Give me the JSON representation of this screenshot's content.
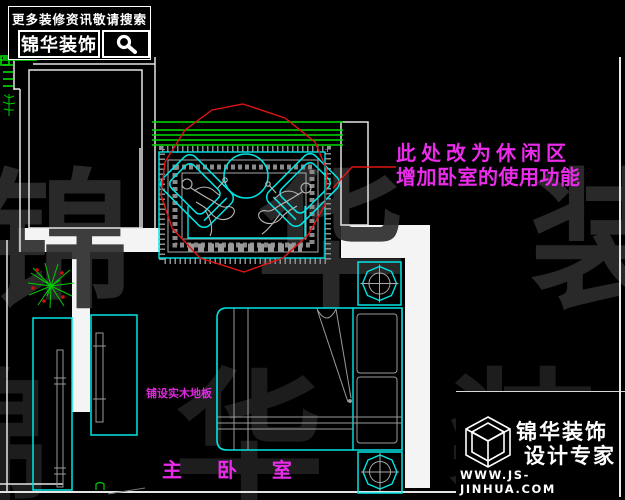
{
  "header_badge": {
    "tagline": "更多装修资讯敬请搜索",
    "brand": "锦华装饰",
    "search_icon": "magnifier"
  },
  "annotation": {
    "line1": "此处改为休闲区",
    "line2": "增加卧室的使用功能"
  },
  "plan_labels": {
    "room_name": "主 卧 室",
    "floor_note": "铺设实木地板"
  },
  "watermark": {
    "row1": "锦 华 装 饰",
    "row2": "锦 华 装 饰"
  },
  "footer_badge": {
    "brand": "锦华装饰",
    "subtitle": "设计专家",
    "website": "WWW.JS-JINHUA.COM",
    "logo_icon": "wireframe-cube"
  },
  "colors": {
    "cad_cyan": "#00e6e6",
    "cad_green": "#00dd00",
    "cad_red": "#e01414",
    "cad_gray": "#a8a8a8",
    "annotation_magenta": "#ea2cea",
    "wall_white": "#f4f4f4",
    "background": "#000000"
  }
}
